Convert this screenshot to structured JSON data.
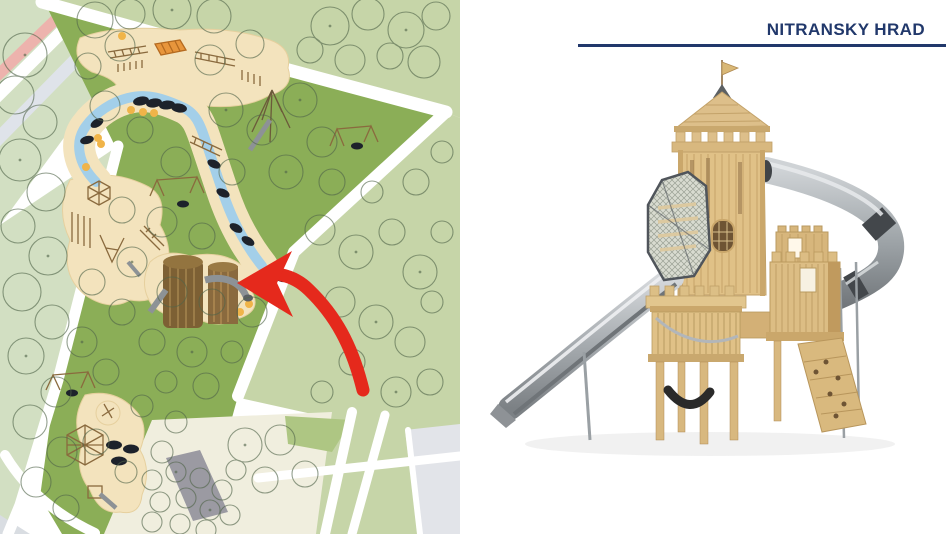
{
  "slide": {
    "title": "NITRANSKY HRAD"
  },
  "palette": {
    "title_navy": "#21386b",
    "rule_navy": "#21386b",
    "arrow_red": "#e5291c",
    "park_green": "#8bae57",
    "pale_green_left": "#d2dfc2",
    "pale_green_right": "#c6d5a8",
    "sand_beige": "#f3e3bd",
    "stream_blue": "#a3cfe9",
    "path_pink": "#edb3ad",
    "plaza_cream": "#f0eede",
    "paving_grey": "#9b9aa2",
    "orange_dot": "#f0b449",
    "wood_light": "#e0c187",
    "wood_dark": "#b08a52",
    "steel_grey": "#9ea3a7"
  },
  "map": {
    "features": [
      "park-lawn",
      "tree-canopies",
      "sand-playgrounds",
      "dry-stream",
      "stepping-pads",
      "castle-tower-site",
      "red-arrow-marker",
      "footpaths"
    ]
  },
  "product": {
    "name": "wooden-castle-tower-with-slides"
  }
}
